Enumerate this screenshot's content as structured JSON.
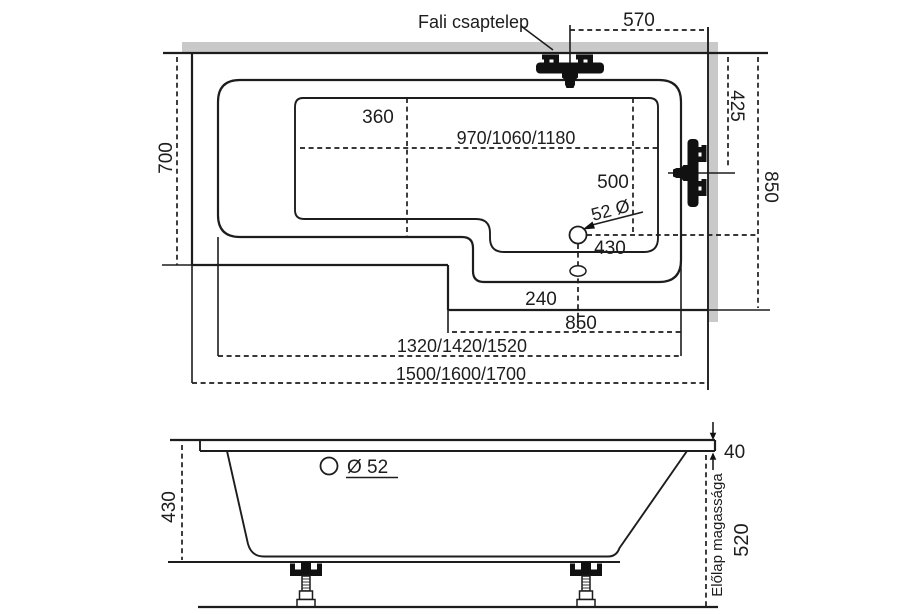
{
  "colors": {
    "line": "#1d1d1d",
    "wall_fill": "#c9c9c9",
    "background": "#ffffff",
    "fixture_fill": "#111111"
  },
  "top_view": {
    "wall_faucet_label": "Fali csaptelep",
    "faucet_offset": "570",
    "left_section_width": "700",
    "seat_length": "360",
    "basin_lengths": "970/1060/1180",
    "faucet_height": "425",
    "overall_width": "850",
    "basin_width": "500",
    "drain_diameter": "52 Ø",
    "drain_to_end": "430",
    "drain_offset_bottom": "240",
    "drain_span": "850",
    "rim_lengths": "1320/1420/1520",
    "overall_lengths": "1500/1600/1700"
  },
  "side_view": {
    "tub_depth": "430",
    "hole_diameter": "Ø 52",
    "rim_thickness": "40",
    "front_panel_height": "520",
    "front_panel_label": "Előlap magassága"
  }
}
